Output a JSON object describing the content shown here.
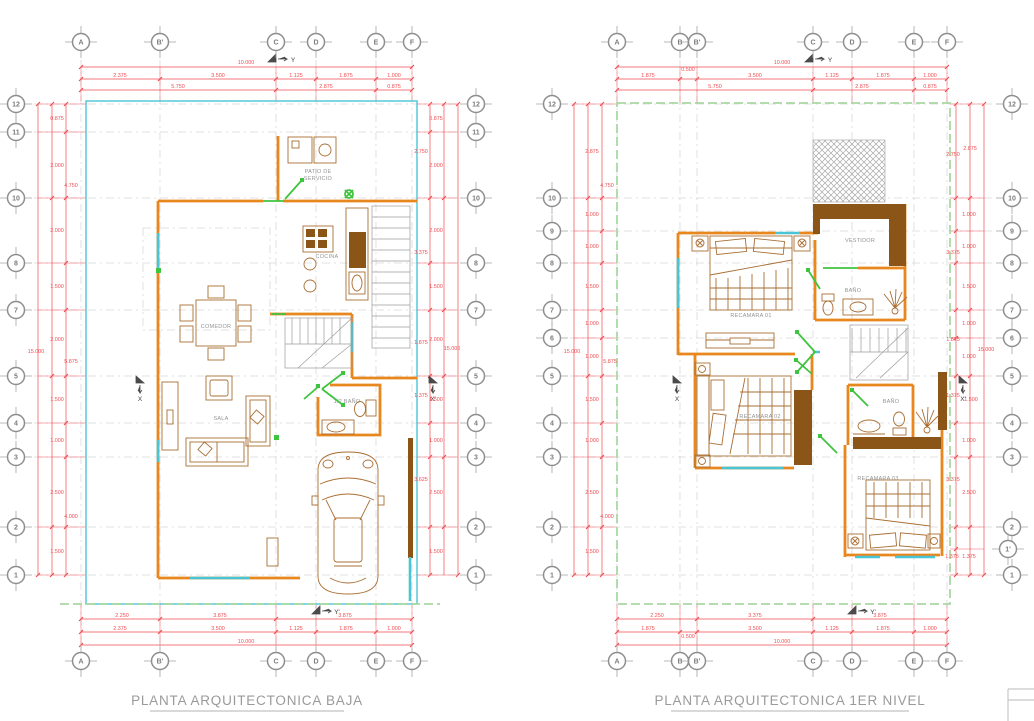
{
  "colors": {
    "red": "#ef4b50",
    "orange": "#e8871e",
    "brown": "#8a5516",
    "furn": "#aa6e33",
    "cyan": "#49c5d6",
    "green": "#3fc43f",
    "lgreen": "#a9d8a2",
    "gray": "#9b9b9b",
    "tgray": "#8f8f8f"
  },
  "plans": [
    {
      "title": "PLANTA ARQUITECTONICA BAJA",
      "grid_cols": [
        "A",
        "B'",
        "C",
        "D",
        "E",
        "F"
      ],
      "grid_rows": [
        "12",
        "11",
        "10",
        "8",
        "7",
        "5",
        "4",
        "3",
        "2",
        "1"
      ],
      "axes": {
        "top": "Y",
        "bottom": "Y'",
        "left": "X",
        "right": "X'"
      },
      "rooms": {
        "patio_line1": "PATIO DE",
        "patio_line2": "SERVICIO",
        "cocina": "COCINA",
        "comedor": "COMEDOR",
        "sala": "SALA",
        "medio_bano": "1/2 BAÑO"
      },
      "dims": {
        "top": {
          "total": "10.000",
          "row1": [
            "2.375",
            "3.500",
            "1.125",
            "1.875",
            "1.000"
          ],
          "row2": [
            "5.750",
            "2.875",
            "0.875"
          ]
        },
        "bottom": {
          "row1": [
            "2.250",
            "3.875",
            "3.875"
          ],
          "row2": [
            "2.375",
            "3.500",
            "1.125",
            "1.875",
            "1.000"
          ],
          "total": "10.000"
        },
        "left": [
          "0.875",
          "2.000",
          "4.750",
          "2.000",
          "1.500",
          "2.000",
          "15.000",
          "5.875",
          "1.500",
          "1.000",
          "2.500",
          "4.000",
          "1.500"
        ],
        "right": [
          "0.875",
          "2.750",
          "2.000",
          "2.000",
          "3.375",
          "1.500",
          "2.000",
          "15.000",
          "1.875",
          "1.375",
          "1.500",
          "1.000",
          "3.625",
          "2.500",
          "1.500"
        ]
      }
    },
    {
      "title": "PLANTA ARQUITECTONICA 1ER NIVEL",
      "grid_cols": [
        "A",
        "B",
        "B'",
        "C",
        "D",
        "E",
        "F"
      ],
      "grid_rows_left": [
        "12",
        "10",
        "9",
        "8",
        "7",
        "6",
        "5",
        "4",
        "3",
        "2",
        "1"
      ],
      "grid_rows_right": [
        "12",
        "10",
        "9",
        "8",
        "7",
        "6",
        "5",
        "4",
        "3",
        "2",
        "1'",
        "1"
      ],
      "axes": {
        "top": "Y",
        "bottom": "Y'",
        "left": "X",
        "right": "X'"
      },
      "rooms": {
        "recamara01": "RECAMARA 01",
        "vestidor": "VESTIDOR",
        "bano_sup": "BAÑO",
        "recamara02": "RECAMARA 02",
        "bano_inf": "BAÑO",
        "recamara03": "RECAMARA 03"
      },
      "dims": {
        "top": {
          "total": "10.000",
          "row1": [
            "1.875",
            "0.500",
            "3.500",
            "1.125",
            "1.875",
            "1.000"
          ],
          "row2": [
            "5.750",
            "2.875",
            "0.875"
          ]
        },
        "bottom": {
          "row1": [
            "2.250",
            "3.375",
            "3.875"
          ],
          "row2": [
            "1.875",
            "0.500",
            "3.500",
            "1.125",
            "1.875",
            "1.000"
          ],
          "total": "10.000"
        },
        "left": [
          "2.875",
          "4.750",
          "1.000",
          "1.000",
          "1.500",
          "1.000",
          "15.000",
          "1.000",
          "5.875",
          "1.500",
          "1.000",
          "2.500",
          "4.000",
          "1.500"
        ],
        "right": [
          "2.750",
          "2.875",
          "1.000",
          "1.000",
          "3.375",
          "1.500",
          "1.000",
          "1.875",
          "15.000",
          "1.000",
          "1.375",
          "1.500",
          "1.000",
          "3.375",
          "2.500",
          "1.375",
          "1.375"
        ]
      }
    }
  ]
}
